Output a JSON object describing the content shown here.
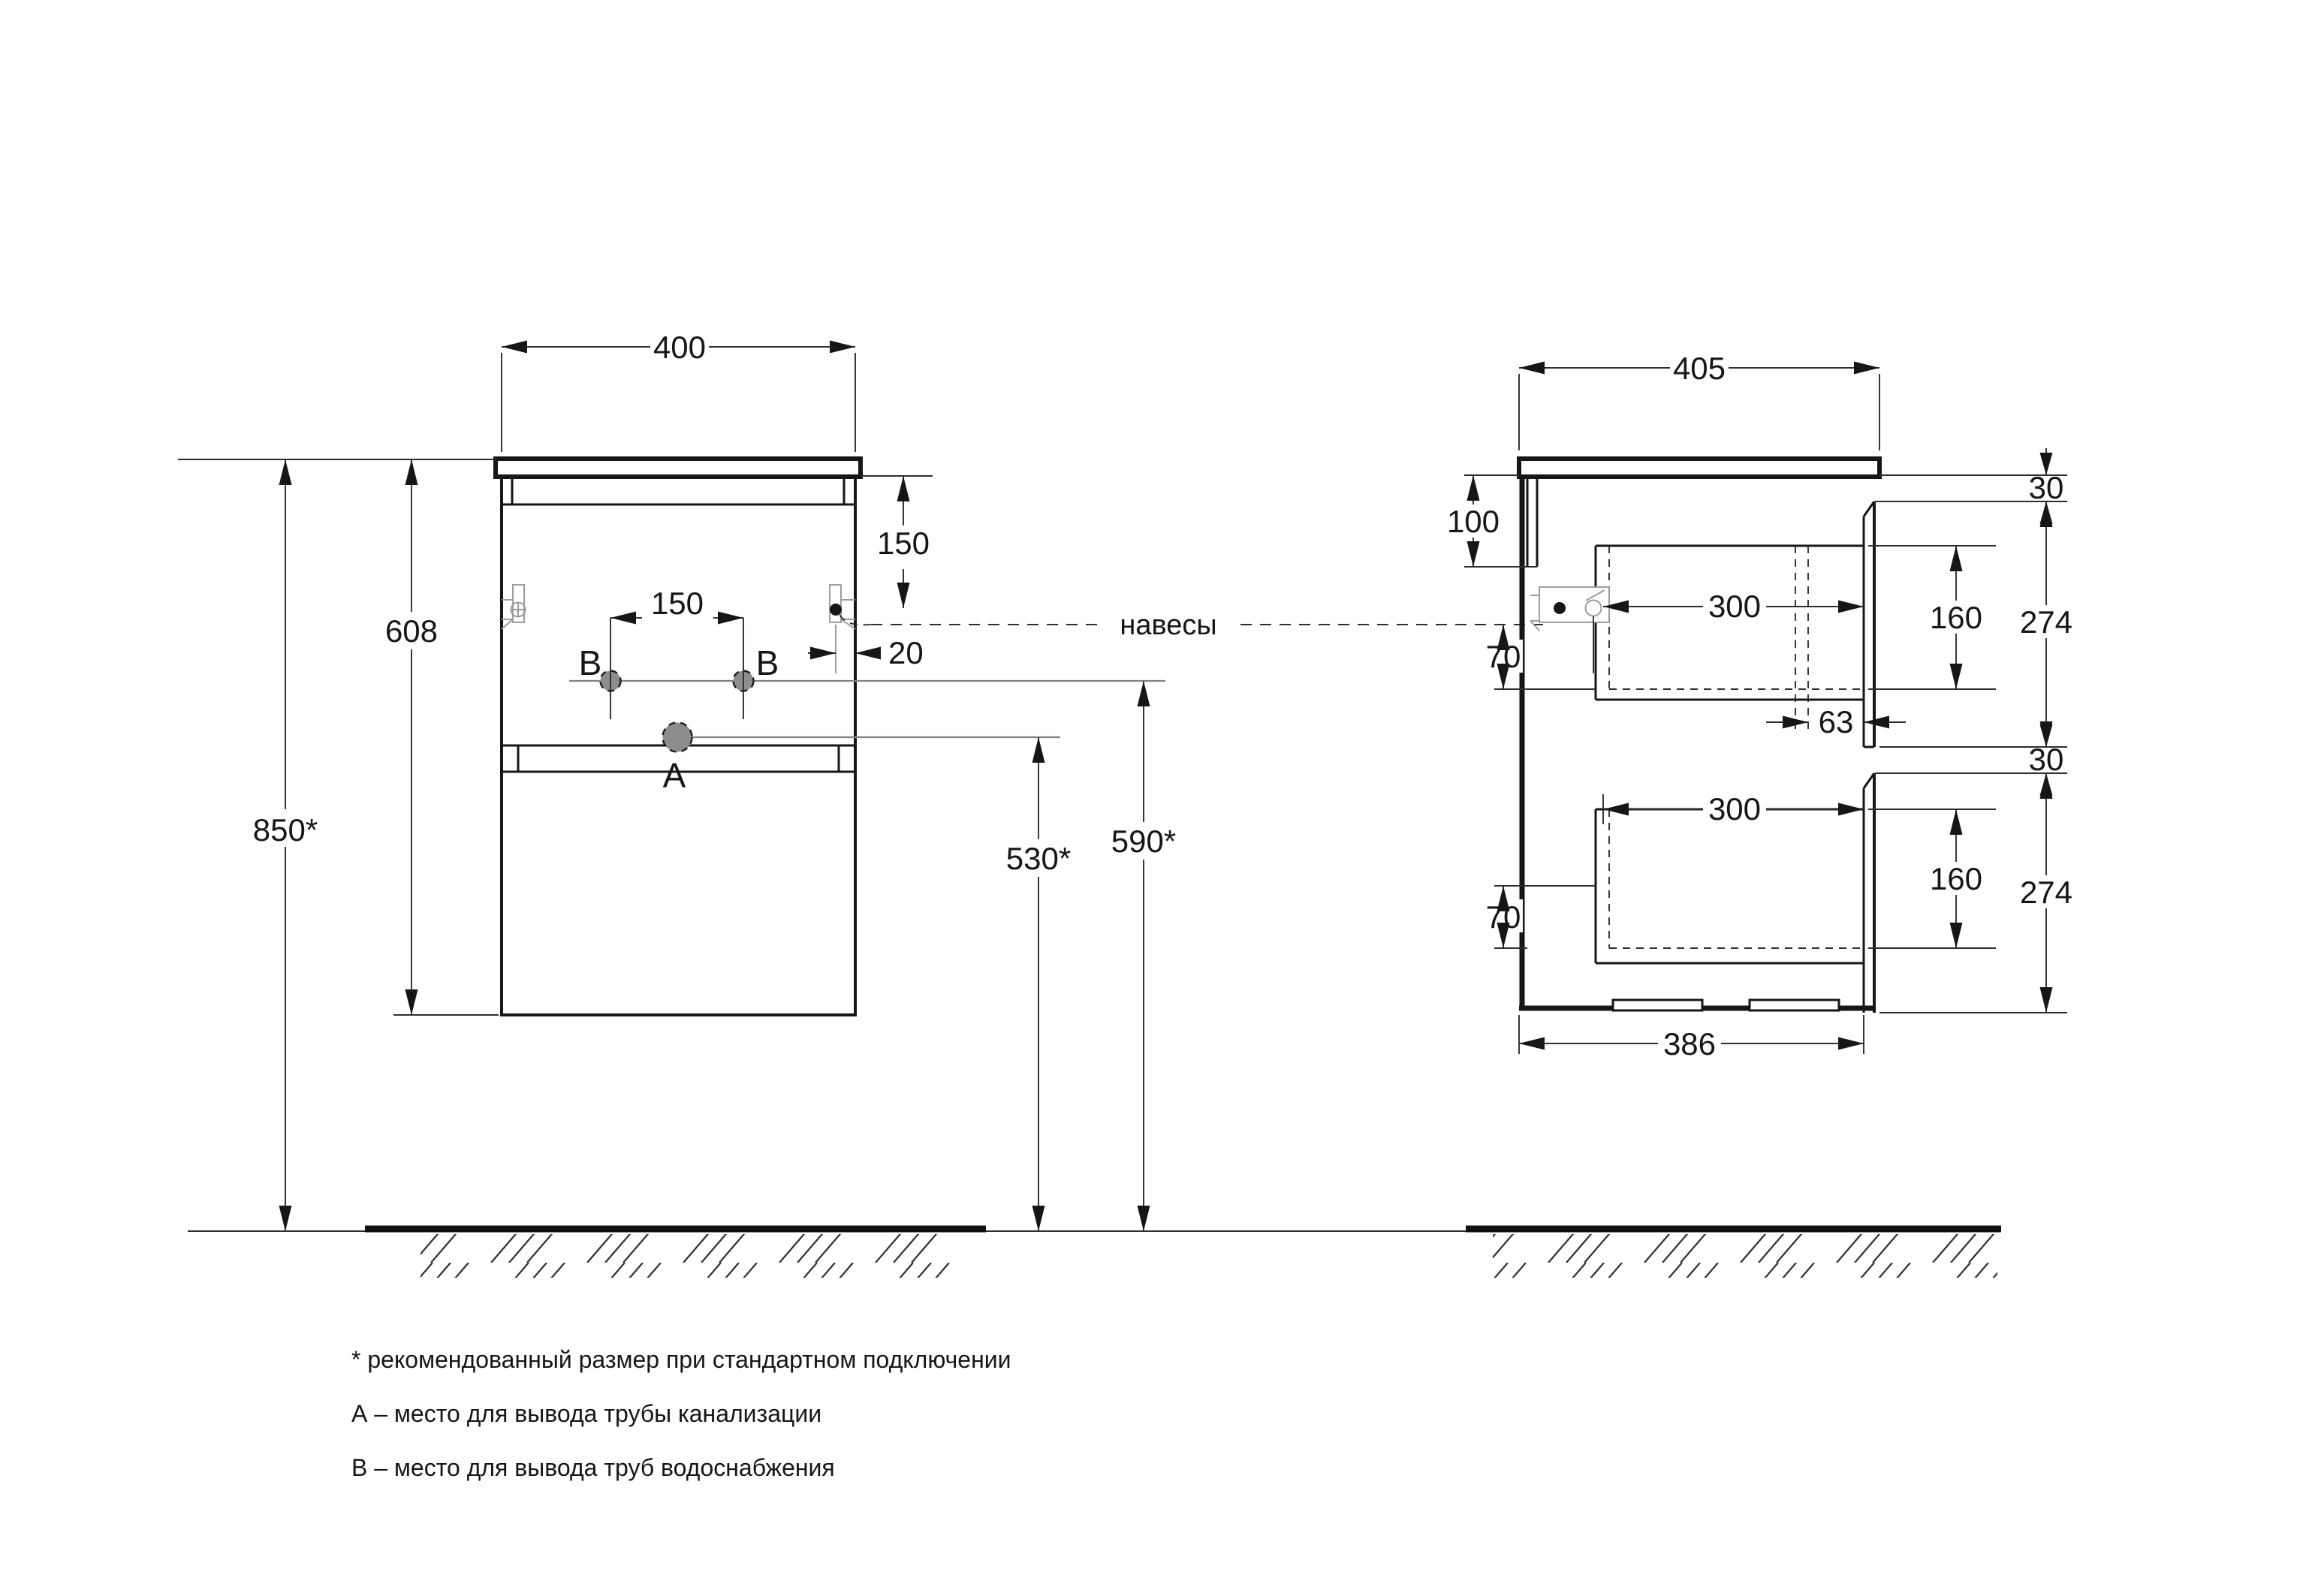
{
  "front": {
    "dim_width": "400",
    "dim_total_height": "850*",
    "dim_body_height": "608",
    "dim_top_to_hanger": "150",
    "dim_hole_spacing": "150",
    "dim_hanger_inset": "20",
    "dim_drain_height": "530*",
    "dim_supply_height": "590*",
    "label_drain": "A",
    "label_supply_left": "B",
    "label_supply_right": "B"
  },
  "side": {
    "dim_depth": "405",
    "dim_back_rail_height": "100",
    "dim_counter_to_front_gap": "30",
    "dim_front_height_upper": "274",
    "dim_fronts_gap": "30",
    "dim_front_height_lower": "274",
    "dim_drawer_inset_upper": "70",
    "dim_drawer_depth_upper": "300",
    "dim_drawer_box_height_upper": "160",
    "dim_drawer_inset_lower": "70",
    "dim_drawer_depth_lower": "300",
    "dim_drawer_box_height_lower": "160",
    "dim_stop_to_front": "63",
    "dim_base_depth": "386"
  },
  "callouts": {
    "hangers": "навесы"
  },
  "notes": {
    "asterisk": "* рекомендованный размер при стандартном подключении",
    "a": "А – место для вывода трубы канализации",
    "b": "В – место для вывода труб водоснабжения"
  }
}
